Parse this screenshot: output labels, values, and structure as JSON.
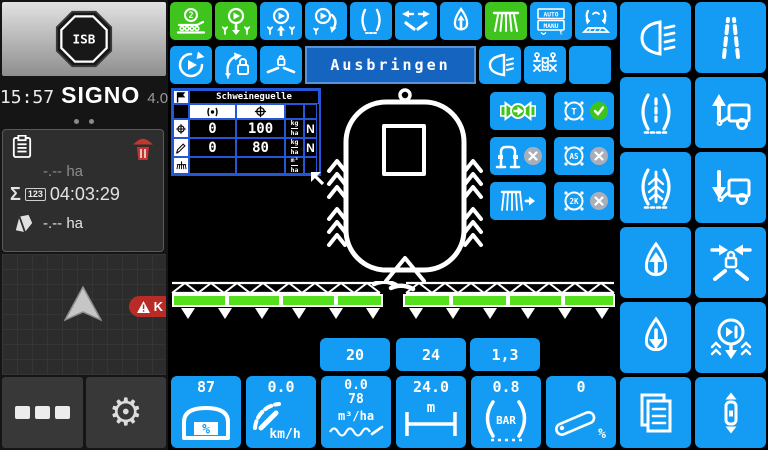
{
  "sidebar": {
    "isb": "ISB",
    "time": "15:57",
    "brand": "SIGNO",
    "version": "4.0",
    "counters": {
      "area_trip": "-.-- ha",
      "sigma": "Σ",
      "badge": "123",
      "total_time": "04:03:29",
      "area_total": "-.-- ha"
    },
    "warning_text": "K"
  },
  "main": {
    "title": "Ausbringen",
    "table": {
      "title": "Schweineguelle",
      "col_icons": [
        "signal-icon",
        "target-icon"
      ],
      "rows": [
        {
          "setpoint": "0",
          "actual": "100",
          "unit_num": "kg",
          "unit_den": "ha",
          "tag": "N"
        },
        {
          "setpoint": "0",
          "actual": "80",
          "unit_num": "kg",
          "unit_den": "ha",
          "tag": "N"
        },
        {
          "setpoint": "",
          "actual": "",
          "unit_num": "m³",
          "unit_den": "ha",
          "tag": ""
        }
      ]
    },
    "labels": {
      "boom2": "2",
      "auto": "AUTO",
      "manu": "MANU",
      "t_small": "t",
      "t": "T",
      "as": "AS",
      "twok": "2K"
    }
  },
  "readouts": {
    "upper": [
      "20",
      "24",
      "1,3"
    ],
    "tiles": [
      {
        "value": "87",
        "unit": "%"
      },
      {
        "value": "0.0",
        "unit": "km/h"
      },
      {
        "value": "0.0",
        "value2": "78",
        "unit": "m³/ha"
      },
      {
        "value": "24.0",
        "unit": "m"
      },
      {
        "value": "0.8",
        "unit": "BAR"
      },
      {
        "value": "0",
        "unit": "%"
      }
    ]
  },
  "colors": {
    "button_blue": "#149bf3",
    "button_green": "#3ec41d",
    "title_blue": "#1565c0",
    "boom_green": "#55e01e",
    "warning_red": "#b92b27",
    "ok_green": "#3fc41c",
    "disabled_gray": "#a9afb8"
  }
}
